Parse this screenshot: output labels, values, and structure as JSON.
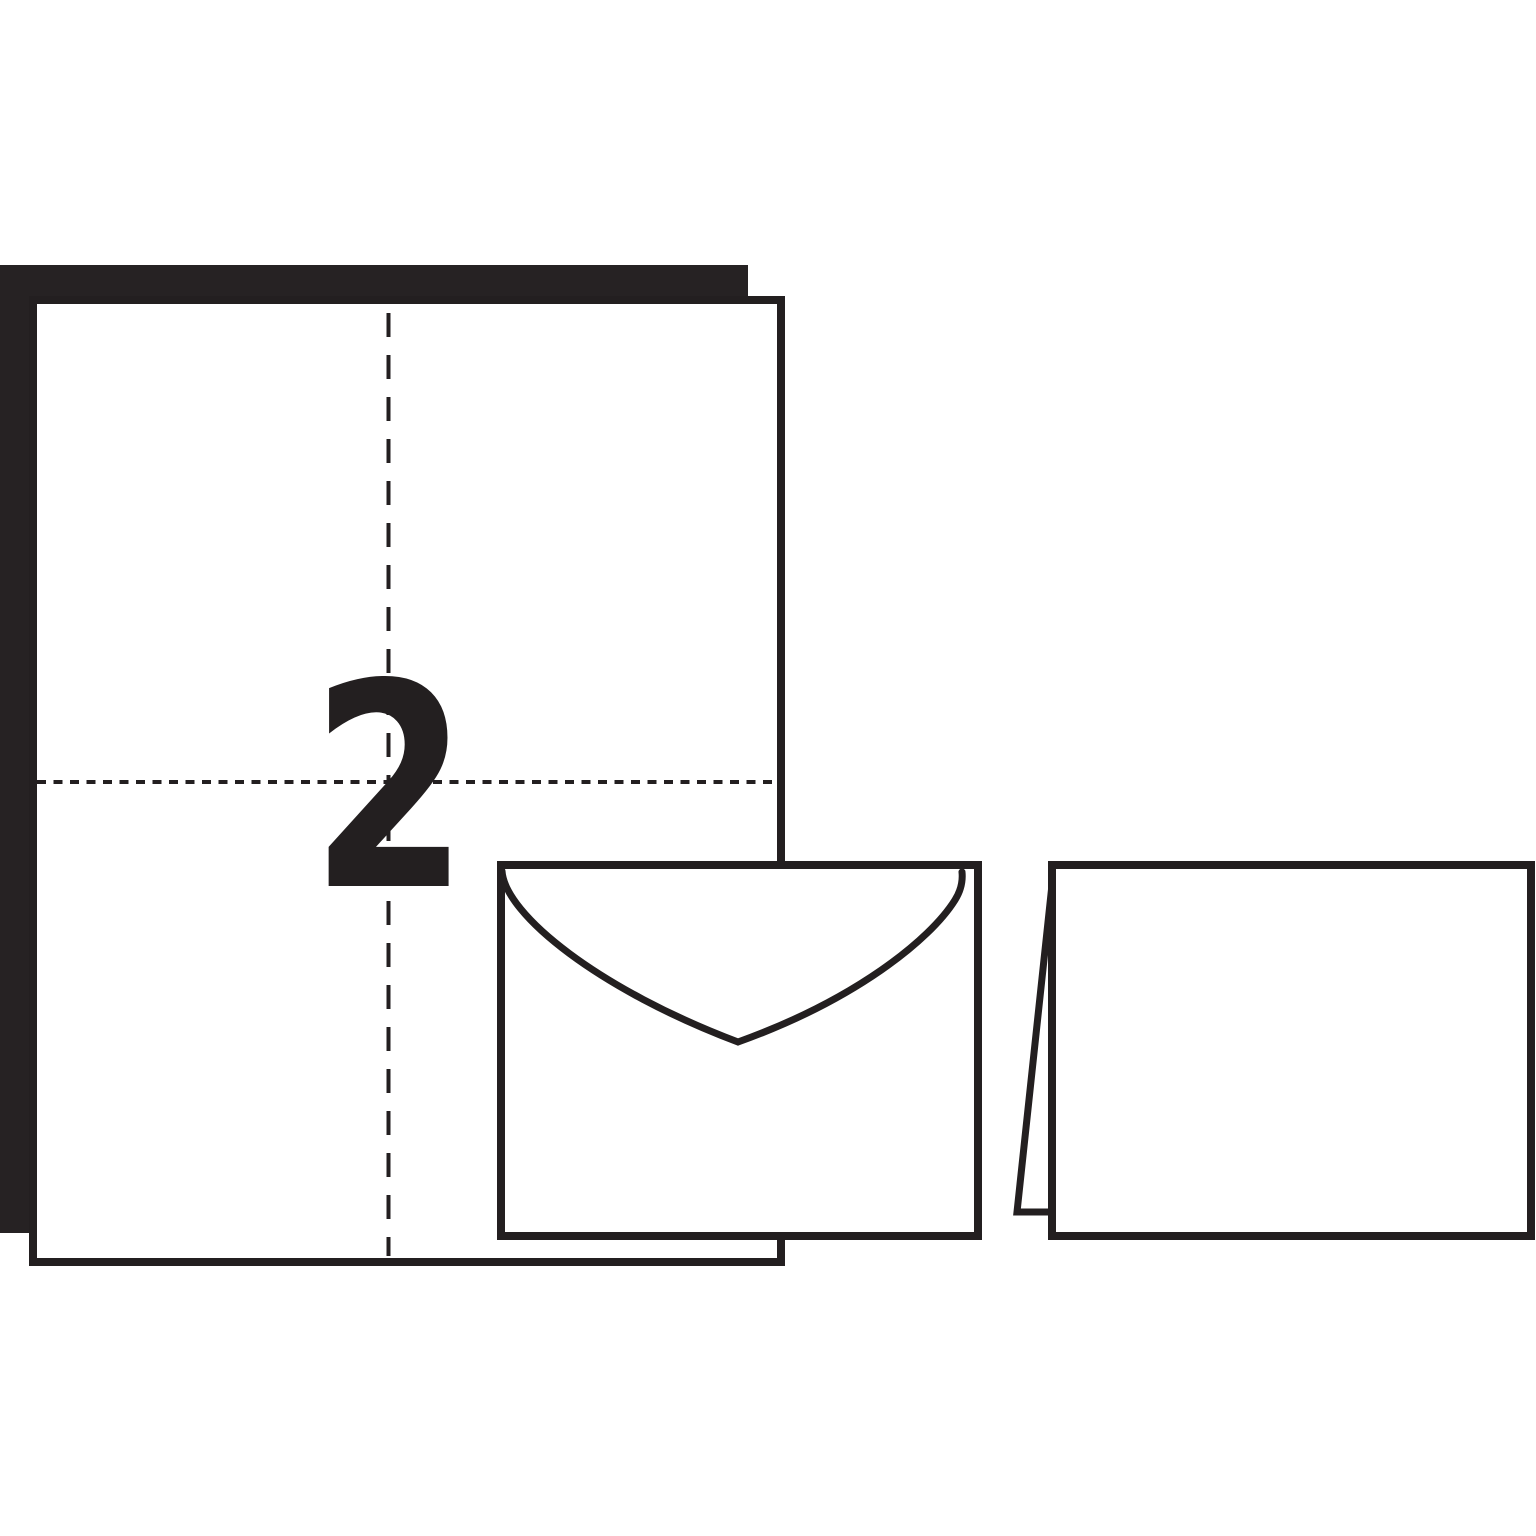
{
  "scene": {
    "count_label": "2",
    "colors": {
      "ink": "#231f20",
      "backing_sheet": "#262223",
      "paper": "#ffffff",
      "background": "#ffffff"
    },
    "objects": {
      "backing_sheet": "backing-sheet",
      "guide_sheet": "sheet-with-fold-and-cut-guides",
      "envelope": "envelope",
      "folded_card": "folded-card"
    }
  }
}
